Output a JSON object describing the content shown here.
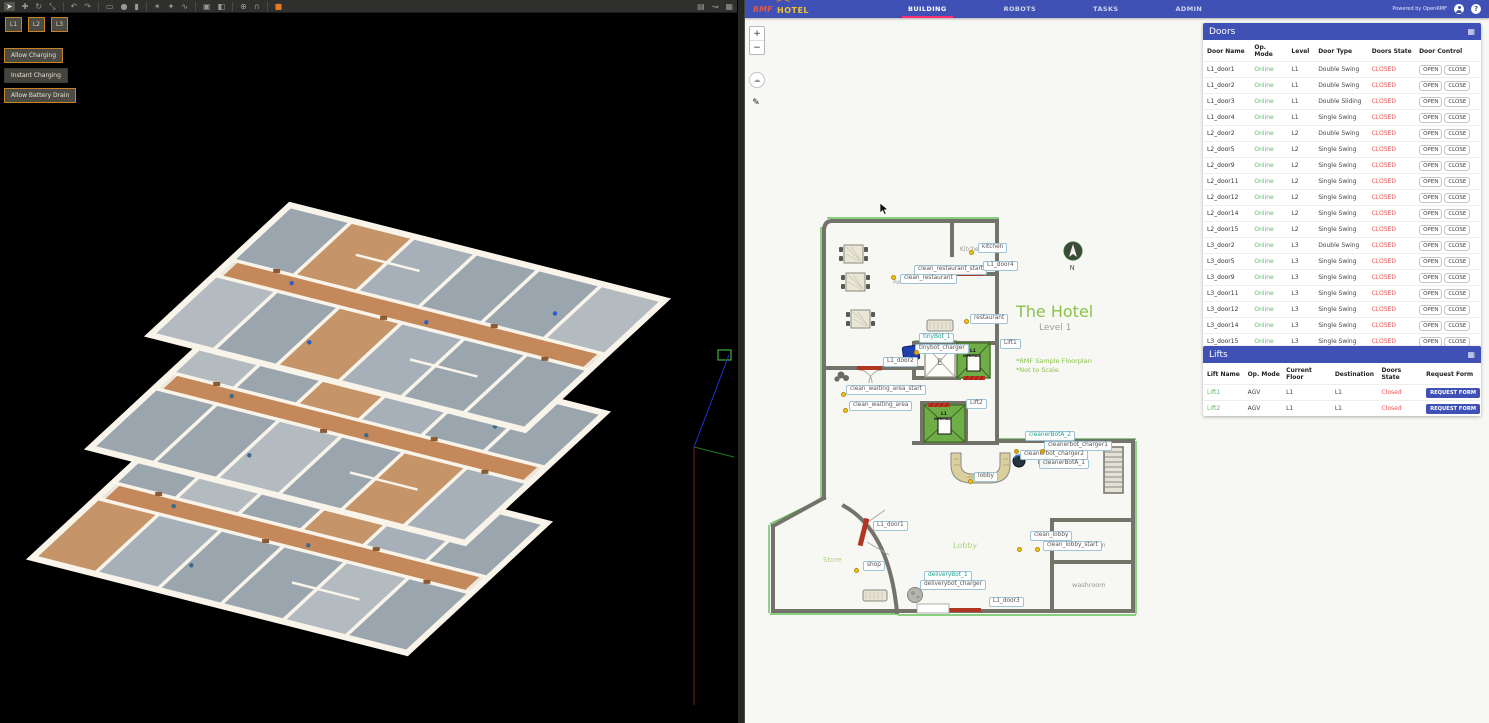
{
  "gazebo": {
    "toolbar_icons": [
      {
        "name": "cursor-icon",
        "glyph": "➤",
        "sel": true
      },
      {
        "name": "translate-icon",
        "glyph": "✚"
      },
      {
        "name": "rotate-icon",
        "glyph": "↻"
      },
      {
        "name": "scale-icon",
        "glyph": "⤡"
      },
      {
        "name": "undo-icon",
        "glyph": "↶"
      },
      {
        "name": "redo-icon",
        "glyph": "↷"
      },
      {
        "name": "box-icon",
        "glyph": "▭"
      },
      {
        "name": "sphere-icon",
        "glyph": "●"
      },
      {
        "name": "cylinder-icon",
        "glyph": "▮"
      },
      {
        "name": "point-light-icon",
        "glyph": "✶"
      },
      {
        "name": "spot-light-icon",
        "glyph": "✦"
      },
      {
        "name": "directional-light-icon",
        "glyph": "∿"
      },
      {
        "name": "copy-icon",
        "glyph": "▣"
      },
      {
        "name": "paste-icon",
        "glyph": "◧"
      },
      {
        "name": "align-icon",
        "glyph": "⊕"
      },
      {
        "name": "snap-icon",
        "glyph": "∩"
      },
      {
        "name": "record-icon",
        "glyph": "■",
        "accent": true
      }
    ],
    "toolbar_right_icons": [
      {
        "name": "screenshot-icon",
        "glyph": "▤"
      },
      {
        "name": "curve-icon",
        "glyph": "↝"
      },
      {
        "name": "camera-icon",
        "glyph": "▦"
      }
    ],
    "level_buttons": [
      "L1",
      "L2",
      "L3"
    ],
    "action_buttons": [
      {
        "label": "Allow Charging",
        "style": "accent"
      },
      {
        "label": "Instant Charging",
        "style": "plain"
      },
      {
        "label": "Allow Battery Drain",
        "style": "accent"
      }
    ]
  },
  "header": {
    "logo_rmf": "RMF",
    "logo_hotel": "HOTEL",
    "tabs": [
      {
        "label": "BUILDING",
        "active": true
      },
      {
        "label": "ROBOTS",
        "active": false
      },
      {
        "label": "TASKS",
        "active": false
      },
      {
        "label": "ADMIN",
        "active": false
      }
    ],
    "powered_by": "Powered by OpenRMF"
  },
  "map_controls": {
    "zoom_in": "+",
    "zoom_out": "−"
  },
  "map": {
    "title": "The Hotel",
    "subtitle": "Level 1",
    "note1": "*RMF Sample Floorplan",
    "note2": "*Not to Scale",
    "compass_n": "N",
    "elevator_letter": "E",
    "lift_line1": "L1",
    "lift_line2": "NORMAL",
    "area_texts": {
      "kitchen": "Kitchen",
      "restaurant": "Restaurant",
      "lobby": "Lobby",
      "store": "Store",
      "washroom": "washroom",
      "washroom2": "washroom"
    },
    "labels": [
      {
        "text": "kitchen",
        "x": 211,
        "y": 28
      },
      {
        "text": "clean_restaurant_start",
        "x": 147,
        "y": 50
      },
      {
        "text": "L1_door4",
        "x": 216,
        "y": 46
      },
      {
        "text": "clean_restaurant",
        "x": 133,
        "y": 59
      },
      {
        "text": "restaurant",
        "x": 203,
        "y": 99
      },
      {
        "text": "tinyBot_1",
        "x": 152,
        "y": 118,
        "robot": true
      },
      {
        "text": "tinybot_charger",
        "x": 148,
        "y": 129
      },
      {
        "text": "Lift1",
        "x": 233,
        "y": 124
      },
      {
        "text": "L1_door2",
        "x": 116,
        "y": 142
      },
      {
        "text": "clean_waiting_area_start",
        "x": 79,
        "y": 170
      },
      {
        "text": "clean_waiting_area",
        "x": 82,
        "y": 186
      },
      {
        "text": "Lift2",
        "x": 199,
        "y": 184
      },
      {
        "text": "cleanerBotA_2",
        "x": 258,
        "y": 216,
        "robot": true
      },
      {
        "text": "cleanerbot_charger1",
        "x": 277,
        "y": 226
      },
      {
        "text": "cleanerbot_charger2",
        "x": 253,
        "y": 235
      },
      {
        "text": "cleanerBotA_1",
        "x": 272,
        "y": 244
      },
      {
        "text": "lobby",
        "x": 207,
        "y": 257
      },
      {
        "text": "L1_door1",
        "x": 106,
        "y": 306
      },
      {
        "text": "clean_lobby",
        "x": 263,
        "y": 316
      },
      {
        "text": "clean_lobby_start",
        "x": 276,
        "y": 326
      },
      {
        "text": "shop",
        "x": 96,
        "y": 346
      },
      {
        "text": "deliveryBot_1",
        "x": 157,
        "y": 356,
        "robot": true
      },
      {
        "text": "deliverybot_charger",
        "x": 153,
        "y": 365
      },
      {
        "text": "L1_door3",
        "x": 222,
        "y": 382
      }
    ],
    "dots": [
      {
        "x": 204,
        "y": 37
      },
      {
        "x": 126,
        "y": 62
      },
      {
        "x": 199,
        "y": 106
      },
      {
        "x": 76,
        "y": 179
      },
      {
        "x": 78,
        "y": 195
      },
      {
        "x": 203,
        "y": 266
      },
      {
        "x": 252,
        "y": 334
      },
      {
        "x": 270,
        "y": 334
      },
      {
        "x": 89,
        "y": 355
      },
      {
        "x": 149,
        "y": 137,
        "orange": true
      },
      {
        "x": 249,
        "y": 236,
        "orange": true
      },
      {
        "x": 275,
        "y": 236,
        "orange": true
      }
    ]
  },
  "doors_panel": {
    "title": "Doors",
    "columns": [
      "Door Name",
      "Op. Mode",
      "Level",
      "Door Type",
      "Doors State",
      "Door Control"
    ],
    "open_label": "OPEN",
    "close_label": "CLOSE",
    "rows": [
      {
        "name": "L1_door1",
        "mode": "Online",
        "level": "L1",
        "type": "Double Swing",
        "state": "CLOSED"
      },
      {
        "name": "L1_door2",
        "mode": "Online",
        "level": "L1",
        "type": "Double Swing",
        "state": "CLOSED"
      },
      {
        "name": "L1_door3",
        "mode": "Online",
        "level": "L1",
        "type": "Double Sliding",
        "state": "CLOSED"
      },
      {
        "name": "L1_door4",
        "mode": "Online",
        "level": "L1",
        "type": "Single Swing",
        "state": "CLOSED"
      },
      {
        "name": "L2_door2",
        "mode": "Online",
        "level": "L2",
        "type": "Double Swing",
        "state": "CLOSED"
      },
      {
        "name": "L2_door5",
        "mode": "Online",
        "level": "L2",
        "type": "Single Swing",
        "state": "CLOSED"
      },
      {
        "name": "L2_door9",
        "mode": "Online",
        "level": "L2",
        "type": "Single Swing",
        "state": "CLOSED"
      },
      {
        "name": "L2_door11",
        "mode": "Online",
        "level": "L2",
        "type": "Single Swing",
        "state": "CLOSED"
      },
      {
        "name": "L2_door12",
        "mode": "Online",
        "level": "L2",
        "type": "Single Swing",
        "state": "CLOSED"
      },
      {
        "name": "L2_door14",
        "mode": "Online",
        "level": "L2",
        "type": "Single Swing",
        "state": "CLOSED"
      },
      {
        "name": "L2_door15",
        "mode": "Online",
        "level": "L2",
        "type": "Single Swing",
        "state": "CLOSED"
      },
      {
        "name": "L3_door2",
        "mode": "Online",
        "level": "L3",
        "type": "Double Swing",
        "state": "CLOSED"
      },
      {
        "name": "L3_door5",
        "mode": "Online",
        "level": "L3",
        "type": "Single Swing",
        "state": "CLOSED"
      },
      {
        "name": "L3_door9",
        "mode": "Online",
        "level": "L3",
        "type": "Single Swing",
        "state": "CLOSED"
      },
      {
        "name": "L3_door11",
        "mode": "Online",
        "level": "L3",
        "type": "Single Swing",
        "state": "CLOSED"
      },
      {
        "name": "L3_door12",
        "mode": "Online",
        "level": "L3",
        "type": "Single Swing",
        "state": "CLOSED"
      },
      {
        "name": "L3_door14",
        "mode": "Online",
        "level": "L3",
        "type": "Single Swing",
        "state": "CLOSED"
      },
      {
        "name": "L3_door15",
        "mode": "Online",
        "level": "L3",
        "type": "Single Swing",
        "state": "CLOSED"
      }
    ]
  },
  "lifts_panel": {
    "title": "Lifts",
    "columns": [
      "Lift Name",
      "Op. Mode",
      "Current Floor",
      "Destination",
      "Doors State",
      "Request Form"
    ],
    "request_label": "REQUEST FORM",
    "rows": [
      {
        "name": "Lift1",
        "mode": "AGV",
        "floor": "L1",
        "destination": "L1",
        "state": "Closed"
      },
      {
        "name": "Lift2",
        "mode": "AGV",
        "floor": "L1",
        "destination": "L1",
        "state": "Closed"
      }
    ]
  }
}
